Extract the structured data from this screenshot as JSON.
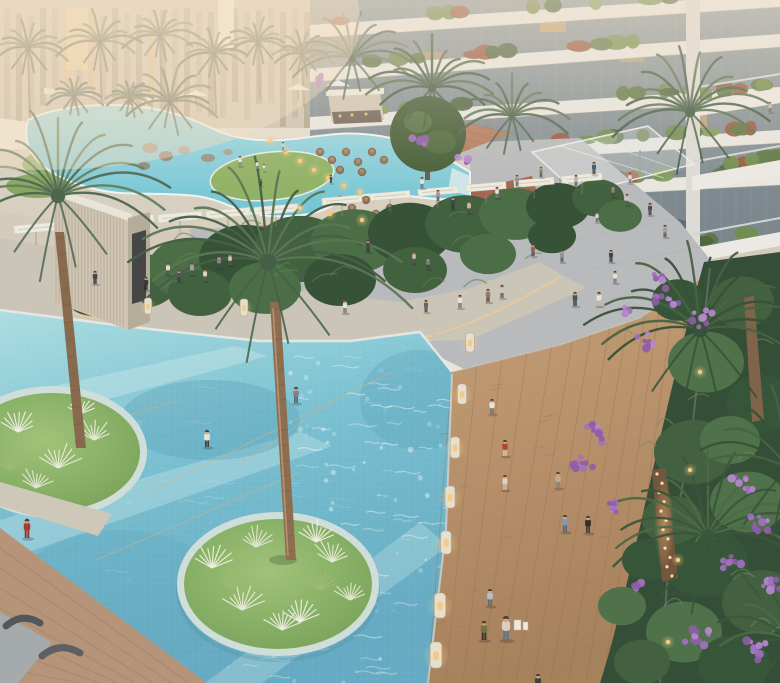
{
  "scene": {
    "kind": "aerial-architectural-render",
    "subject": "resort-courtyard-with-pools-boardwalk-and-palms"
  },
  "colors": {
    "backdrop": "#d4cabb",
    "building_left": "#cfc4b2",
    "building_band": "#e9e7e2",
    "building_glass": "#7f8d93",
    "window_warm": "#e0b16c",
    "storefront": "#57636b",
    "plaza": "#b7b9bc",
    "terracotta": "#b27a5c",
    "red_deck": "#a3604a",
    "lagoon_deck": "#d6cfbf",
    "lawn": "#8fae67",
    "path": "#c8c4b7",
    "hedge_dark": "#2e4c31",
    "hedge_mid": "#3a5c3a",
    "hedge_light": "#446a42",
    "canopy": "#edebdf",
    "pool_top": "#a8dde2",
    "pool_mid": "#74bfd2",
    "pool_deep": "#5fa8c2",
    "island_grass": "#7aa658",
    "island_rim": "#cfdeda",
    "boardwalk_hi": "#c49c74",
    "boardwalk_lo": "#a37e58",
    "plank_line": "#8a6a49",
    "deck_wood": "#b29176",
    "garden_base": "#2c4831",
    "purple_1": "#a06cc0",
    "purple_2": "#b585cf",
    "purple_3": "#8b58a8",
    "bollard_body": "#e7dfcf",
    "bollard_glow": "#f6c97e",
    "led_warm": "#eccb90",
    "palm_trunk": "#8a6a4c",
    "skin": "#c9a183",
    "hair": "#4a3a2c",
    "tuft_white": "#eef2e2",
    "rug": "#a2a8ac",
    "lounger": "#4c5156"
  },
  "people": [
    [
      422,
      188,
      11,
      "#e6e3db",
      "#6b6b6b"
    ],
    [
      438,
      201,
      11,
      "#989a98",
      "#54565a"
    ],
    [
      453,
      209,
      12,
      "#35444f",
      "#2a2e35"
    ],
    [
      469,
      213,
      12,
      "#c2b298",
      "#4c4a44"
    ],
    [
      497,
      198,
      11,
      "#e3e0d8",
      "#75757a"
    ],
    [
      517,
      186,
      11,
      "#8d9196",
      "#4e5257"
    ],
    [
      541,
      177,
      10,
      "#7a8363",
      "#3e4340"
    ],
    [
      576,
      186,
      11,
      "#b7b4ac",
      "#55555a"
    ],
    [
      594,
      174,
      12,
      "#2e4f72",
      "#23303f"
    ],
    [
      613,
      197,
      11,
      "#897962",
      "#4c4438"
    ],
    [
      630,
      183,
      10,
      "#dfdbd0",
      "#696a6e"
    ],
    [
      650,
      215,
      12,
      "#494d54",
      "#303338"
    ],
    [
      665,
      237,
      12,
      "#999fa3",
      "#4a4e53"
    ],
    [
      533,
      256,
      12,
      "#9f5947",
      "#48413b"
    ],
    [
      562,
      262,
      12,
      "#8c929a",
      "#4c5158"
    ],
    [
      611,
      262,
      12,
      "#3b4147",
      "#292d33"
    ],
    [
      597,
      222,
      10,
      "#d6d0c2",
      "#5b5f63"
    ],
    [
      627,
      205,
      11,
      "#c9c4b8",
      "#575550"
    ],
    [
      575,
      306,
      14,
      "#3f5a42",
      "#30363c"
    ],
    [
      599,
      306,
      14,
      "#e8e3d9",
      "#c4b69b"
    ],
    [
      615,
      283,
      12,
      "#e3e0d6",
      "#6e7276"
    ],
    [
      95,
      284,
      13,
      "#3a3e44",
      "#26292e"
    ],
    [
      146,
      290,
      13,
      "#2e3237",
      "#1f2125"
    ],
    [
      168,
      275,
      12,
      "#dedbd1",
      "#4d5055"
    ],
    [
      179,
      282,
      12,
      "#4a4f57",
      "#32353a"
    ],
    [
      192,
      275,
      12,
      "#9a9ea2",
      "#4e5255"
    ],
    [
      205,
      281,
      12,
      "#d5d1c5",
      "#595651"
    ],
    [
      219,
      268,
      12,
      "#798087",
      "#3e434a"
    ],
    [
      230,
      265,
      11,
      "#c8c3b7",
      "#555350"
    ],
    [
      345,
      313,
      13,
      "#e2dfd5",
      "#696c6f"
    ],
    [
      368,
      252,
      12,
      "#3c4450",
      "#2a2f38"
    ],
    [
      414,
      263,
      11,
      "#bcb8ad",
      "#535353"
    ],
    [
      428,
      269,
      11,
      "#747a7f",
      "#3c4045"
    ],
    [
      426,
      312,
      12,
      "#5a5f66",
      "#383c42"
    ],
    [
      460,
      308,
      13,
      "#e5e2da",
      "#6a6e72"
    ],
    [
      488,
      302,
      13,
      "#8a7662",
      "#453d33"
    ],
    [
      502,
      298,
      13,
      "#cdc5b5",
      "#5a544c"
    ],
    [
      296,
      403,
      16,
      "#76808a",
      "#525a62"
    ],
    [
      207,
      447,
      17,
      "#e7e3db",
      "#34383e"
    ],
    [
      505,
      456,
      16,
      "#b23f2b",
      "#c7c0b2"
    ],
    [
      492,
      414,
      15,
      "#e7e4dd",
      "#6a6e73"
    ],
    [
      505,
      490,
      15,
      "#d7d2c7",
      "#d8b49a"
    ],
    [
      558,
      488,
      16,
      "#c1a88b",
      "#897f6f"
    ],
    [
      565,
      532,
      17,
      "#7d97b3",
      "#49617a"
    ],
    [
      588,
      533,
      17,
      "#2d2927",
      "#3a3430"
    ],
    [
      506,
      640,
      24,
      "#d8cebf",
      "#5c7290"
    ],
    [
      484,
      640,
      19,
      "#6a6f45",
      "#2d2b29"
    ],
    [
      490,
      606,
      17,
      "#adbec9",
      "#5e656f"
    ],
    [
      538,
      692,
      18,
      "#3c3a38",
      "#2a2826"
    ],
    [
      27,
      538,
      19,
      "#a83226",
      "#8c2a22"
    ],
    [
      770,
      112,
      10,
      "#c7b8a7",
      "#5e574d"
    ],
    [
      240,
      166,
      10,
      "#e9e7e1",
      "#7a7a7a"
    ],
    [
      257,
      169,
      8,
      "#dde2e6",
      "#8a8a8a"
    ],
    [
      264,
      171,
      7,
      "#e5e1d7",
      "#999999"
    ],
    [
      261,
      186,
      7,
      "#3d454d",
      "#2b2f35"
    ],
    [
      331,
      183,
      8,
      "#3e464e",
      "#2c3036"
    ],
    [
      283,
      150,
      8,
      "#d8d4c8",
      "#777777"
    ]
  ],
  "bags": [
    [
      514,
      620,
      7,
      10
    ],
    [
      523,
      622,
      5,
      8
    ]
  ],
  "bollards": [
    [
      148,
      314,
      0.8
    ],
    [
      244,
      316,
      0.85
    ],
    [
      470,
      352,
      0.95
    ],
    [
      462,
      404,
      1.0
    ],
    [
      455,
      458,
      1.05
    ],
    [
      450,
      508,
      1.1
    ],
    [
      446,
      554,
      1.15
    ],
    [
      440,
      618,
      1.25
    ],
    [
      436,
      668,
      1.3
    ]
  ],
  "glow_lights": [
    [
      270,
      141
    ],
    [
      286,
      152
    ],
    [
      300,
      161
    ],
    [
      314,
      170
    ],
    [
      328,
      178
    ],
    [
      344,
      186
    ],
    [
      360,
      192
    ],
    [
      300,
      208
    ],
    [
      330,
      214
    ],
    [
      362,
      220
    ],
    [
      700,
      372
    ],
    [
      690,
      470
    ],
    [
      678,
      560
    ],
    [
      668,
      642
    ]
  ],
  "purple_clusters": [
    [
      668,
      298,
      16,
      10
    ],
    [
      702,
      318,
      14,
      8
    ],
    [
      646,
      342,
      12,
      7
    ],
    [
      598,
      432,
      16,
      10
    ],
    [
      582,
      462,
      14,
      8
    ],
    [
      616,
      506,
      13,
      8
    ],
    [
      746,
      482,
      15,
      9
    ],
    [
      762,
      522,
      13,
      8
    ],
    [
      728,
      562,
      14,
      9
    ],
    [
      700,
      640,
      16,
      10
    ],
    [
      754,
      650,
      14,
      9
    ],
    [
      772,
      586,
      12,
      7
    ],
    [
      636,
      586,
      11,
      6
    ],
    [
      626,
      310,
      10,
      6
    ],
    [
      660,
      278,
      10,
      6
    ],
    [
      320,
      80,
      8,
      5
    ],
    [
      420,
      140,
      9,
      5
    ],
    [
      463,
      160,
      7,
      4
    ]
  ],
  "grass_tufts": [
    [
      212,
      568,
      10,
      "#eef2e2"
    ],
    [
      242,
      610,
      11,
      "#e8eed8"
    ],
    [
      300,
      622,
      10,
      "#eef2e2"
    ],
    [
      332,
      562,
      10,
      "#e4ecd4"
    ],
    [
      256,
      547,
      9,
      "#dfe8cf"
    ],
    [
      316,
      542,
      9,
      "#eef2e2"
    ],
    [
      282,
      630,
      9,
      "#e8eed8"
    ],
    [
      350,
      600,
      8,
      "#dfe8cf"
    ],
    [
      230,
      588,
      7,
      "#9cba74"
    ],
    [
      320,
      590,
      8,
      "#9cba74"
    ],
    [
      18,
      432,
      10,
      "#eef2e2"
    ],
    [
      58,
      468,
      11,
      "#e8eed8"
    ],
    [
      94,
      440,
      9,
      "#e4ecd4"
    ],
    [
      36,
      488,
      9,
      "#dfe8cf"
    ],
    [
      80,
      414,
      8,
      "#eef2e2"
    ],
    [
      10,
      470,
      8,
      "#9cba74"
    ],
    [
      706,
      432,
      9,
      "#9ab884"
    ],
    [
      748,
      546,
      9,
      "#ccd8c0"
    ],
    [
      622,
      602,
      8,
      "#9ab884"
    ],
    [
      664,
      662,
      9,
      "#ccd8c0"
    ],
    [
      776,
      474,
      8,
      "#9ab884"
    ],
    [
      692,
      500,
      8,
      "#ccd8c0"
    ],
    [
      640,
      632,
      7,
      "#9ab884"
    ],
    [
      6,
      668,
      10,
      "#2e4a30"
    ],
    [
      14,
      676,
      8,
      "#3a5a3a"
    ]
  ],
  "palm_heads": [
    [
      268,
      262,
      140,
      18,
      "#55724e",
      "#3f5a42"
    ],
    [
      58,
      196,
      120,
      15,
      "#5d7a55",
      "#46624a"
    ],
    [
      700,
      330,
      125,
      16,
      "#3f5e3e",
      "#2f4c33"
    ],
    [
      708,
      536,
      115,
      15,
      "#44653f",
      "#335236"
    ],
    [
      690,
      112,
      88,
      14,
      "#4e6a49",
      "#3b5540"
    ],
    [
      788,
      468,
      105,
      12,
      "#3f5e3e",
      "#2f4c33"
    ],
    [
      792,
      642,
      95,
      11,
      "#44653f",
      "#335236"
    ],
    [
      352,
      58,
      62,
      12,
      "#6f7d66",
      "#596851"
    ],
    [
      432,
      88,
      70,
      13,
      "#506b4a",
      "#3e5840"
    ],
    [
      512,
      116,
      58,
      11,
      "#5c7355",
      "#485f46"
    ],
    [
      170,
      102,
      48,
      10,
      "#6f7d66",
      "#596851"
    ]
  ],
  "date_palms": [
    [
      28,
      48,
      1.0
    ],
    [
      100,
      42,
      1.05
    ],
    [
      160,
      36,
      0.95
    ],
    [
      214,
      54,
      0.85
    ],
    [
      258,
      42,
      0.8
    ],
    [
      302,
      54,
      0.75
    ],
    [
      74,
      96,
      0.7
    ],
    [
      130,
      98,
      0.65
    ]
  ],
  "wicker_chairs": [
    [
      320,
      152
    ],
    [
      332,
      160
    ],
    [
      346,
      152
    ],
    [
      358,
      162
    ],
    [
      372,
      152
    ],
    [
      384,
      160
    ],
    [
      340,
      170
    ],
    [
      362,
      172
    ],
    [
      340,
      200
    ],
    [
      352,
      208
    ],
    [
      366,
      200
    ],
    [
      376,
      214
    ],
    [
      346,
      218
    ],
    [
      390,
      208
    ]
  ],
  "water_lines": [
    [
      150,
      492,
      392,
      372
    ],
    [
      238,
      466,
      332,
      402
    ],
    [
      96,
      560,
      300,
      472
    ],
    [
      60,
      436,
      180,
      400
    ]
  ],
  "hedge_blobs": [
    [
      95,
      295,
      30
    ],
    [
      140,
      281,
      38
    ],
    [
      190,
      268,
      42
    ],
    [
      245,
      258,
      46
    ],
    [
      300,
      249,
      46
    ],
    [
      355,
      241,
      44
    ],
    [
      410,
      233,
      42
    ],
    [
      465,
      224,
      40
    ],
    [
      515,
      214,
      36
    ],
    [
      558,
      206,
      32
    ],
    [
      598,
      198,
      26
    ],
    [
      620,
      216,
      22
    ],
    [
      120,
      306,
      26
    ],
    [
      200,
      293,
      32
    ],
    [
      265,
      288,
      36
    ],
    [
      340,
      280,
      36
    ],
    [
      415,
      270,
      32
    ],
    [
      488,
      254,
      28
    ],
    [
      552,
      236,
      24
    ]
  ],
  "garden_blobs": [
    [
      742,
      302,
      32
    ],
    [
      706,
      362,
      38
    ],
    [
      762,
      404,
      36
    ],
    [
      694,
      452,
      40
    ],
    [
      748,
      502,
      38
    ],
    [
      704,
      562,
      44
    ],
    [
      762,
      602,
      40
    ],
    [
      684,
      632,
      38
    ],
    [
      734,
      664,
      36
    ],
    [
      642,
      662,
      28
    ],
    [
      622,
      606,
      24
    ],
    [
      648,
      560,
      26
    ],
    [
      672,
      520,
      30
    ],
    [
      730,
      440,
      30
    ],
    [
      678,
      300,
      26
    ]
  ],
  "caustics": {
    "seed": 7
  }
}
